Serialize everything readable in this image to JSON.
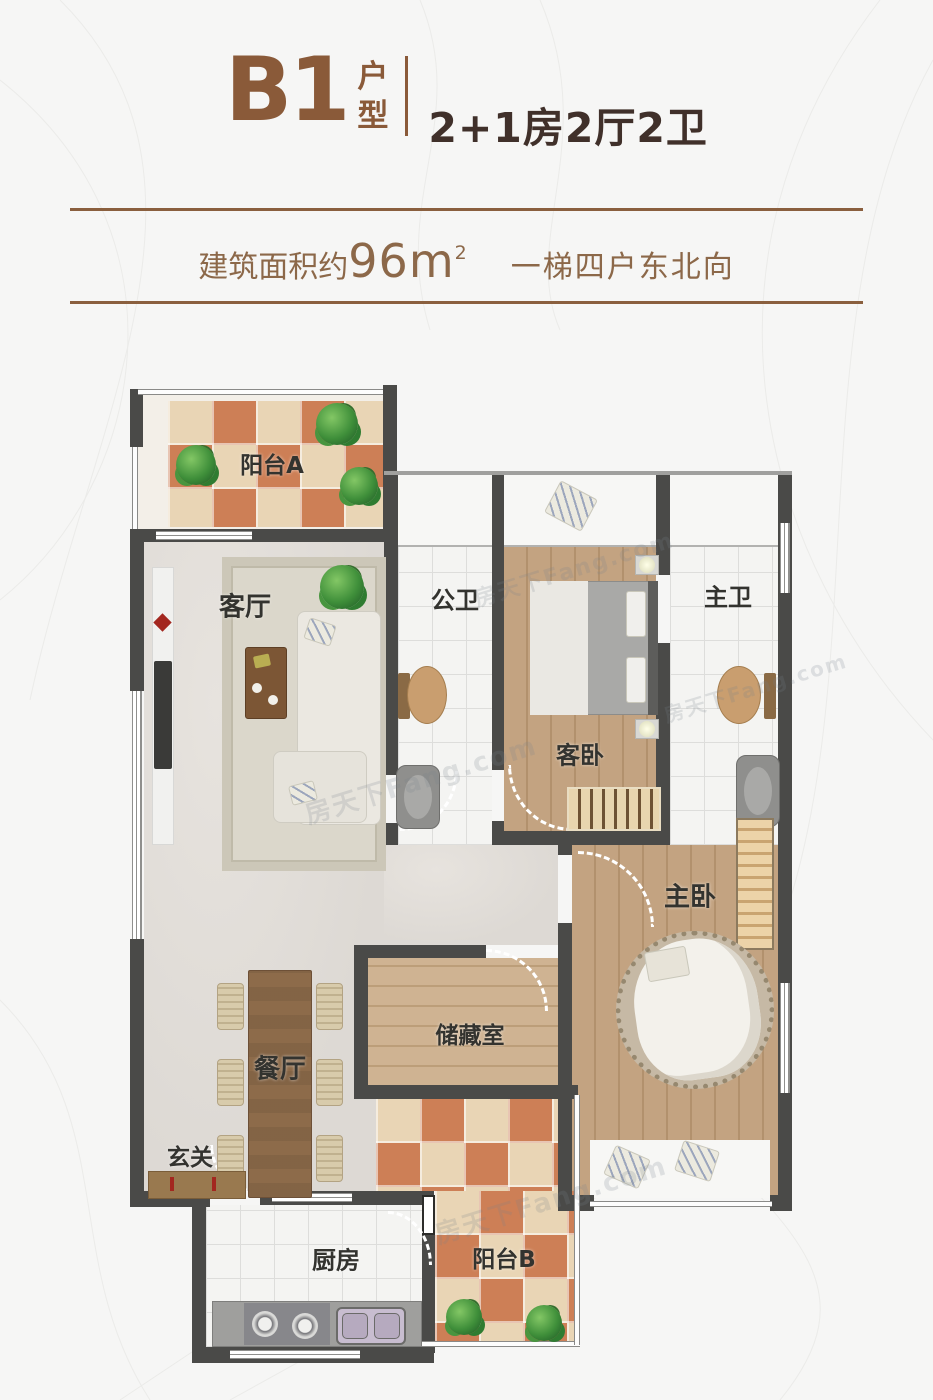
{
  "header": {
    "unit_code": "B1",
    "unit_label": "户型",
    "layout_desc": "2+1房2厅2卫"
  },
  "subheader": {
    "area_prefix": "建筑面积约",
    "area_value": "96m",
    "area_sup": "2",
    "orientation": "一梯四户东北向"
  },
  "watermark": {
    "text": "房天下Fang.com"
  },
  "colors": {
    "accent_brown": "#8a5a39",
    "dark_text": "#40302a",
    "wall": "#4a4a48",
    "tile_orange": "#cd7f56",
    "tile_cream": "#e9d5b5",
    "wood": "#c3a381",
    "marble": "#e0dcd7"
  },
  "rooms": [
    {
      "id": "balcony-a",
      "label": "阳台A"
    },
    {
      "id": "living-room",
      "label": "客厅"
    },
    {
      "id": "public-bath",
      "label": "公卫"
    },
    {
      "id": "guest-bedroom",
      "label": "客卧"
    },
    {
      "id": "master-bath",
      "label": "主卫"
    },
    {
      "id": "master-bedroom",
      "label": "主卧"
    },
    {
      "id": "dining-room",
      "label": "餐厅"
    },
    {
      "id": "storage-room",
      "label": "储藏室"
    },
    {
      "id": "entry",
      "label": "玄关"
    },
    {
      "id": "kitchen",
      "label": "厨房"
    },
    {
      "id": "balcony-b",
      "label": "阳台B"
    }
  ]
}
